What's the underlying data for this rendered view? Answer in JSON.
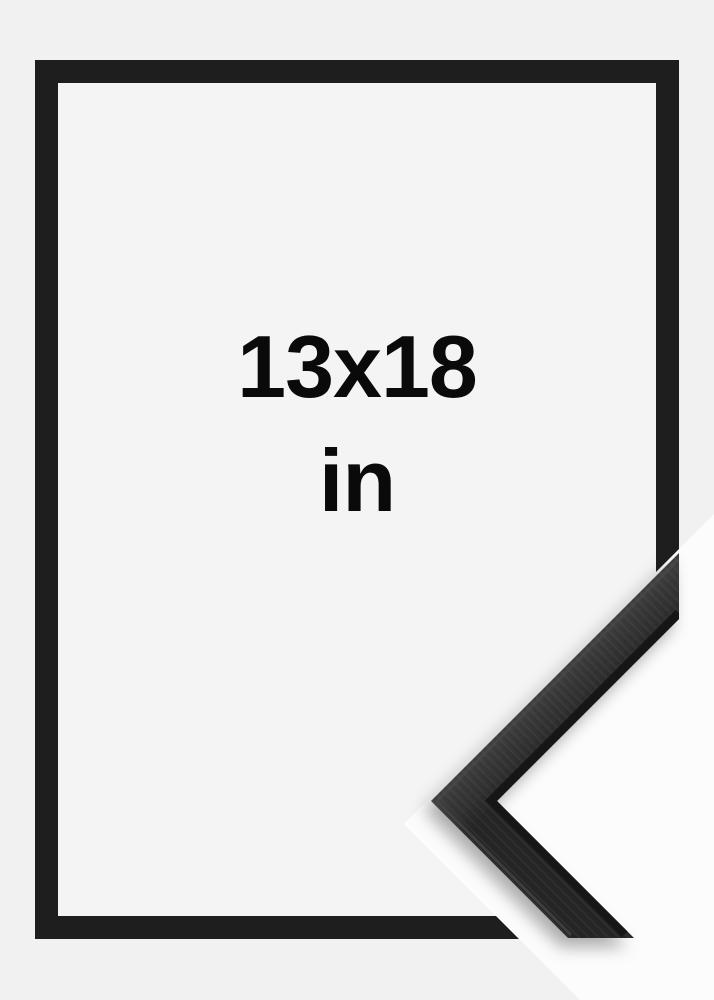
{
  "frame_mockup": {
    "size_label": "13x18",
    "unit_label": "in"
  },
  "colors": {
    "page_bg": "#f1f1f1",
    "inner_bg": "#f4f4f4",
    "frame_fill": "#1e1e1e",
    "photo_bg": "#fcfcfc",
    "moulding_face_light": "#404040",
    "moulding_face_dark": "#282828",
    "moulding_lip": "#141414",
    "moulding_sheen": "#4a4a4a",
    "text_color": "#0a0a0a"
  }
}
